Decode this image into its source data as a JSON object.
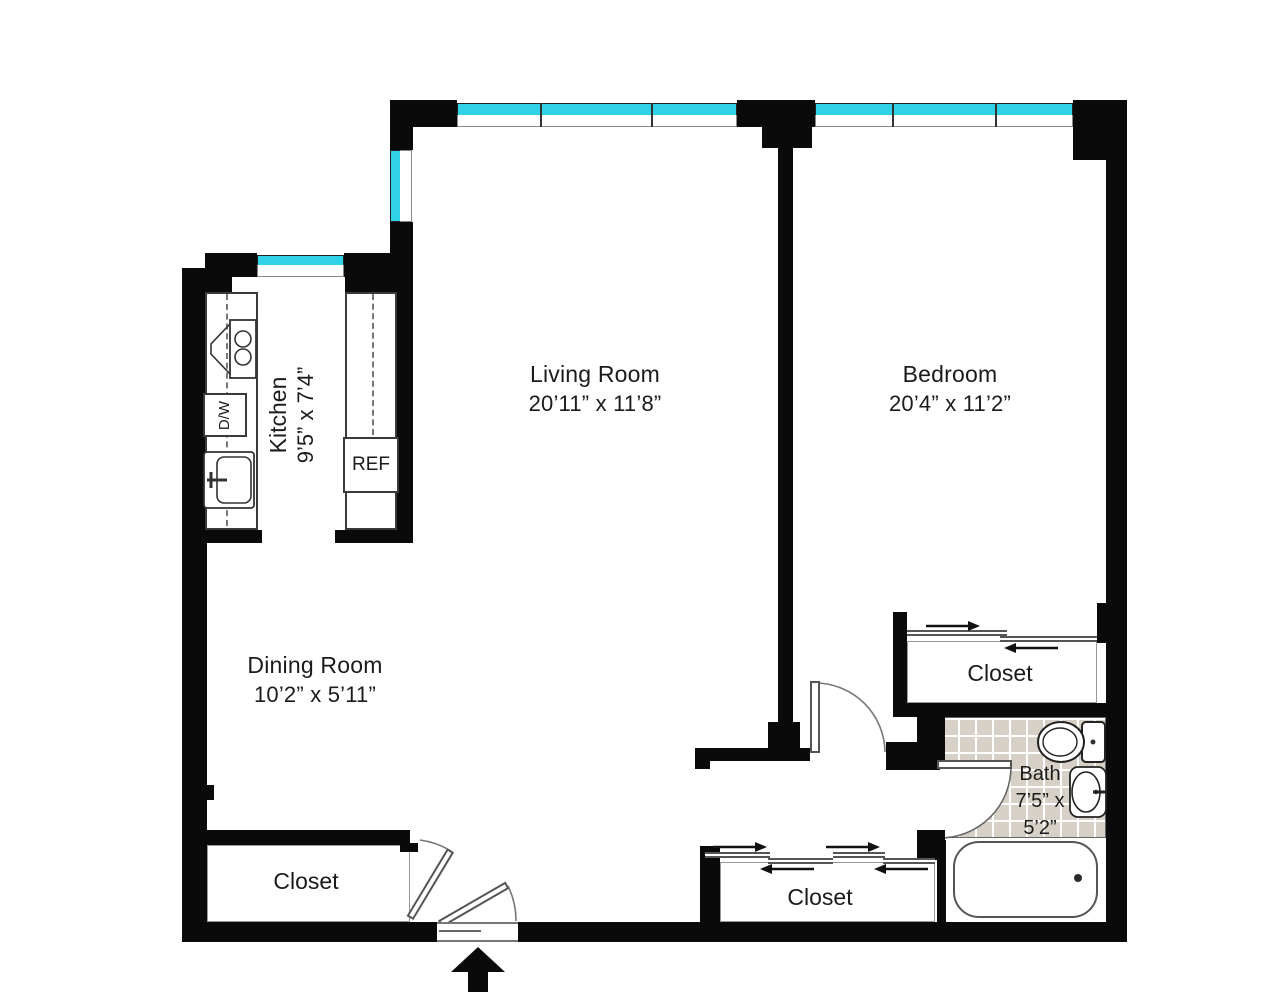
{
  "colors": {
    "wall": "#0a0a0a",
    "window_glass": "#2fd2e6",
    "bath_tile": "#d6d0c6",
    "fixture_line": "#444444",
    "text": "#1b1b1b"
  },
  "rooms": {
    "living": {
      "name": "Living Room",
      "dims": "20’11” x 11’8”"
    },
    "bedroom": {
      "name": "Bedroom",
      "dims": "20’4” x 11’2”"
    },
    "dining": {
      "name": "Dining Room",
      "dims": "10’2” x 5’11”"
    },
    "kitchen": {
      "name": "Kitchen",
      "dims": "9’5” x 7’4”"
    },
    "bath": {
      "name": "Bath",
      "dims": "7’5” x 5’2”",
      "lines": [
        "Bath",
        "7’5” x",
        "5’2”"
      ]
    }
  },
  "closets": {
    "dining_closet": "Closet",
    "hall_closet": "Closet",
    "bedroom_closet": "Closet"
  },
  "appliances": {
    "refrigerator": "REF",
    "dishwasher": "D/W"
  },
  "fixtures": {
    "range": "range",
    "kitchen_sink": "kitchen-sink",
    "toilet": "toilet",
    "vanity_sink": "vanity-sink",
    "bathtub": "bathtub"
  },
  "doors": {
    "entry": "entry-door",
    "bedroom": "bedroom-door",
    "bath": "bath-door",
    "dining_closet": "closet-swing-door",
    "sliding": "sliding-bypass-doors"
  },
  "entry_marker": "entry-arrow"
}
